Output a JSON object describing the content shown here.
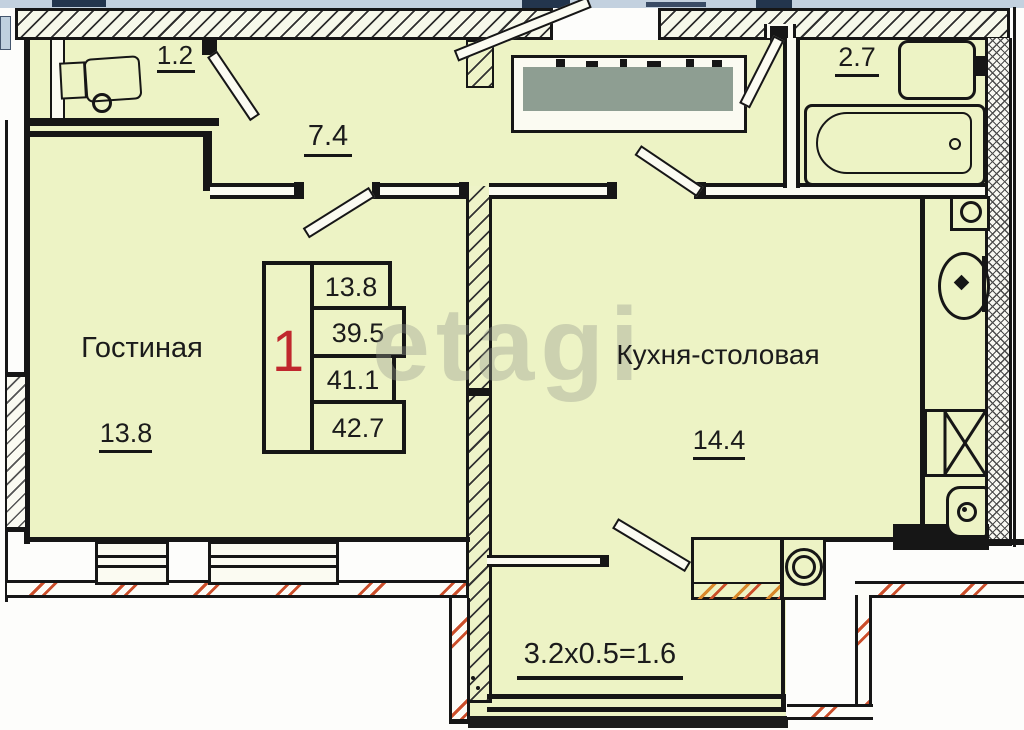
{
  "plan": {
    "kind": "apartment-floor-plan",
    "stamp": {
      "number": "1",
      "areas": [
        "13.8",
        "39.5",
        "41.1",
        "42.7"
      ]
    },
    "labels": {
      "closet_area": "1.2",
      "hallway_area": "7.4",
      "bathroom_area": "2.7",
      "living_name": "Гостиная",
      "living_area": "13.8",
      "kitchen_name": "Кухня-столовая",
      "kitchen_area": "14.4",
      "balcony_dimension": "3.2x0.5=1.6"
    },
    "watermark": "etagi",
    "colors": {
      "room_fill": "#edf3c5",
      "wall": "#161616",
      "stamp_number_red": "#c0272d",
      "redacted_box": "#8e9e92",
      "exterior_red_hatch": "#cb4e2a",
      "counter_orange_hatch": "#d9882b",
      "top_strip_blue": "#c3d1df"
    }
  }
}
